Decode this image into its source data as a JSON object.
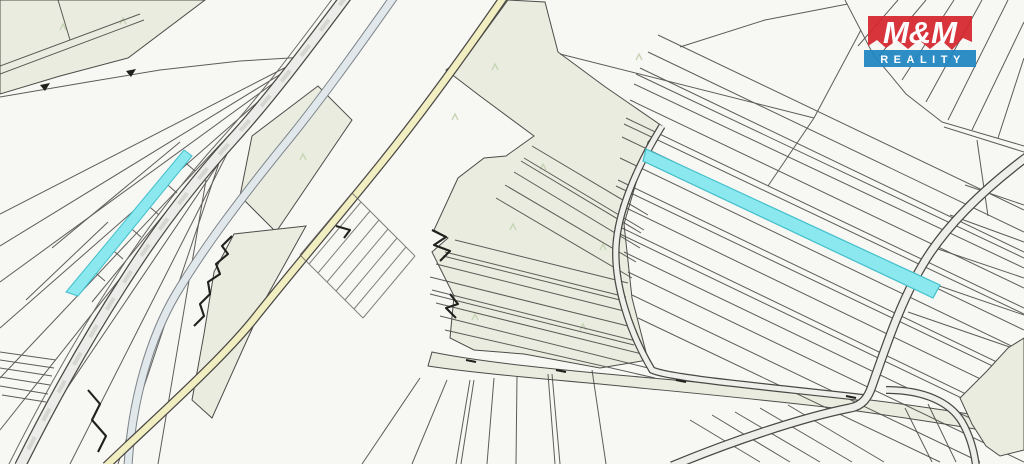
{
  "brand": {
    "name": "M&M",
    "tagline": "REALITY",
    "red": "#d5262f",
    "blue": "#1f86c2",
    "text_color": "#ffffff"
  },
  "map": {
    "description": "cadastral parcel map with two highlighted parcels",
    "background": "#f7f7f4",
    "parcel_line_color": "#4e4c49",
    "forest_fill": "#e9ecdf",
    "road_fill": "#ececea",
    "path_fill_yellow": "#f1eec2",
    "stream_fill": "#e0e8ec",
    "highlight_fill": "#8ae8ee",
    "highlight_stroke": "#42bfcb",
    "highlighted_parcels": [
      "left-narrow-parcel",
      "right-long-parcel"
    ]
  }
}
